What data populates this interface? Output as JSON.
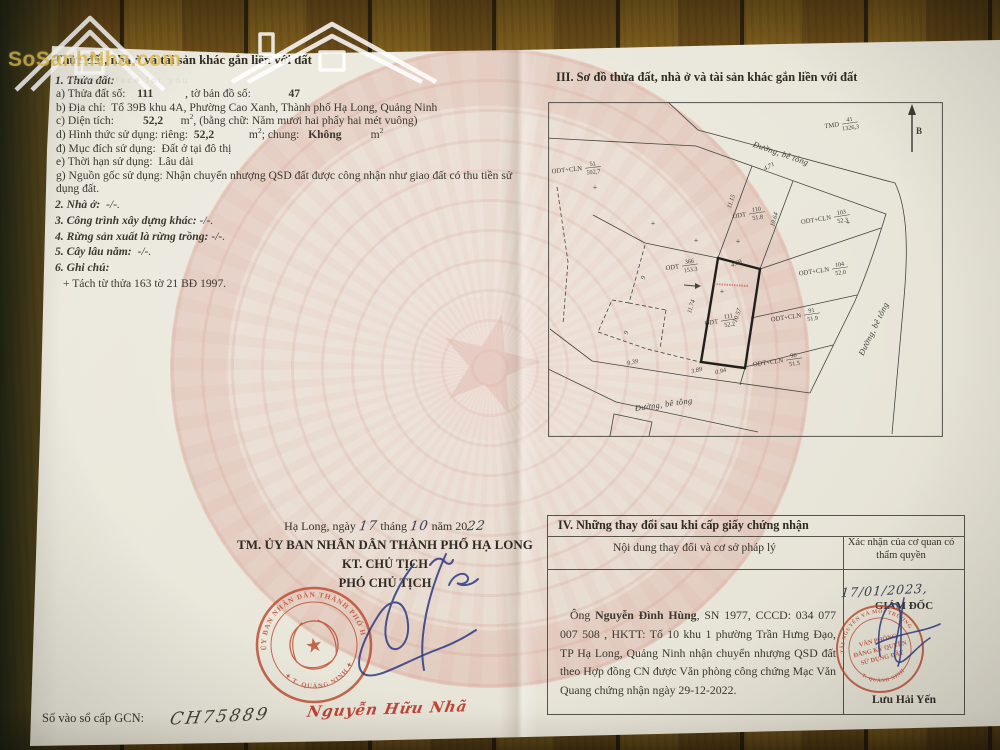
{
  "site_watermark": {
    "brand": "SoSanhNha.com",
    "tagline": "Great place for you"
  },
  "section2": {
    "heading": "II. Thửa đất, nhà ở và tài sản khác gắn liền với đất",
    "lines": [
      {
        "cls": "num",
        "segs": [
          {
            "t": "1. Thửa đất:",
            "bi": 1
          }
        ]
      },
      {
        "cls": "sub",
        "segs": [
          {
            "t": "a) Thửa đất số:    "
          },
          {
            "t": "111",
            "b": 1
          },
          {
            "t": "           , tờ bản đồ số:             "
          },
          {
            "t": "47",
            "b": 1
          }
        ]
      },
      {
        "cls": "sub",
        "segs": [
          {
            "t": "b) Địa chỉ:  Tổ 39B khu 4A, Phường Cao Xanh, Thành phố Hạ Long, Quảng Ninh"
          }
        ]
      },
      {
        "cls": "sub",
        "segs": [
          {
            "t": "c) Diện tích:          "
          },
          {
            "t": "52,2",
            "b": 1
          },
          {
            "t": "      m"
          },
          {
            "t": "2",
            "sup": 1
          },
          {
            "t": ", (bằng chữ: Năm mươi hai phẩy hai mét vuông)"
          }
        ]
      },
      {
        "cls": "sub",
        "segs": [
          {
            "t": "d) Hình thức sử dụng: riêng:  "
          },
          {
            "t": "52,2",
            "b": 1
          },
          {
            "t": "            m"
          },
          {
            "t": "2",
            "sup": 1
          },
          {
            "t": "; chung:   "
          },
          {
            "t": "Không",
            "b": 1
          },
          {
            "t": "          m"
          },
          {
            "t": "2",
            "sup": 1
          }
        ]
      },
      {
        "cls": "sub",
        "segs": [
          {
            "t": "đ) Mục đích sử dụng:  Đất ở tại đô thị"
          }
        ]
      },
      {
        "cls": "sub",
        "segs": [
          {
            "t": "e) Thời hạn sử dụng:  Lâu dài"
          }
        ]
      },
      {
        "cls": "sub",
        "segs": [
          {
            "t": "g) Nguồn gốc sử dụng: Nhận chuyển nhượng QSD đất được công nhận như giao đất có thu tiền sử dụng đất."
          }
        ]
      },
      {
        "cls": "num g",
        "segs": [
          {
            "t": "2. Nhà ở:",
            "bi": 1
          },
          {
            "t": "  -/-.",
            "i": 1
          }
        ]
      },
      {
        "cls": "num g",
        "segs": [
          {
            "t": "3. Công trình xây dựng khác:",
            "bi": 1
          },
          {
            "t": " -/-.",
            "i": 1
          }
        ]
      },
      {
        "cls": "num g",
        "segs": [
          {
            "t": "4. Rừng sản xuất là rừng trồng:",
            "bi": 1
          },
          {
            "t": " -/-.",
            "i": 1
          }
        ]
      },
      {
        "cls": "num g",
        "segs": [
          {
            "t": "5. Cây lâu năm:",
            "bi": 1
          },
          {
            "t": "  -/-.",
            "i": 1
          }
        ]
      },
      {
        "cls": "num g",
        "segs": [
          {
            "t": "6. Ghi chú:",
            "bi": 1
          }
        ]
      },
      {
        "cls": "note g",
        "segs": [
          {
            "t": "+ Tách từ thửa 163 tờ 21 BĐ 1997."
          }
        ]
      }
    ]
  },
  "issue_block": {
    "dateline": [
      {
        "t": "Hạ Long, ngày "
      },
      {
        "t": "17",
        "hand": 1
      },
      {
        "t": " tháng "
      },
      {
        "t": "10",
        "hand": 1
      },
      {
        "t": " năm 20"
      },
      {
        "t": "22",
        "hand": 1
      }
    ],
    "authority": "TM. ỦY BAN NHÂN DÂN THÀNH PHỐ HẠ LONG",
    "title1": "KT. CHỦ TỊCH",
    "title2": "PHÓ CHỦ TỊCH",
    "signer": "Nguyễn Hữu Nhã",
    "stamp": {
      "ring_top": "ỦY BAN NHÂN DÂN THÀNH PHỐ HẠ LONG",
      "ring_bottom": "✦ T. QUẢNG NINH ✦"
    }
  },
  "gcn": {
    "label": "Số vào sổ cấp GCN:",
    "value": "CH75889"
  },
  "section3": {
    "heading": "III. Sơ đồ thửa đất, nhà ở và tài sản khác gắn liền với đất",
    "north": {
      "label": "B"
    },
    "parcels": [
      {
        "code": "TMD",
        "num": "41",
        "area": "1326,3",
        "x": 293,
        "y": 22,
        "rot": -8
      },
      {
        "code": "ODT+CLN",
        "num": "51",
        "area": "592,7",
        "x": 36,
        "y": 66,
        "rot": -6
      },
      {
        "code": "ODT",
        "num": "110",
        "area": "51.8",
        "x": 200,
        "y": 112,
        "rot": -9
      },
      {
        "code": "ODT+CLN",
        "num": "103",
        "area": "52.3",
        "x": 285,
        "y": 115,
        "rot": -9
      },
      {
        "code": "ODT",
        "num": "366",
        "area": "153.3",
        "x": 133,
        "y": 164,
        "rot": -8
      },
      {
        "code": "ODT+CLN",
        "num": "104",
        "area": "52.0",
        "x": 283,
        "y": 167,
        "rot": -8
      },
      {
        "code": "ODT",
        "num": "111",
        "area": "52.2",
        "x": 172,
        "y": 219,
        "rot": -9,
        "bold": true
      },
      {
        "code": "ODT+CLN",
        "num": "91",
        "area": "51.9",
        "x": 255,
        "y": 213,
        "rot": -8
      },
      {
        "code": "ODT+CLN",
        "num": "90",
        "area": "51.5",
        "x": 237,
        "y": 258,
        "rot": -8
      }
    ],
    "dimensions": [
      {
        "t": "4.71",
        "x": 222,
        "y": 66,
        "rot": -30
      },
      {
        "t": "11.15",
        "x": 185,
        "y": 100,
        "rot": -72
      },
      {
        "t": "10.64",
        "x": 228,
        "y": 118,
        "rot": -74
      },
      {
        "t": "4.69",
        "x": 189,
        "y": 163,
        "rot": -22
      },
      {
        "t": "11.74",
        "x": 145,
        "y": 205,
        "rot": -73
      },
      {
        "t": "10.57",
        "x": 191,
        "y": 214,
        "rot": -71
      },
      {
        "t": "9.39",
        "x": 85,
        "y": 262,
        "rot": -13
      },
      {
        "t": "3.89",
        "x": 149,
        "y": 270,
        "rot": -14
      },
      {
        "t": "0.94",
        "x": 173,
        "y": 271,
        "rot": -14
      }
    ],
    "road_labels": [
      {
        "t": "Đường, bê tông",
        "x": 232,
        "y": 54,
        "rot": 19
      },
      {
        "t": "Đường, bê tông",
        "x": 328,
        "y": 228,
        "rot": -64
      },
      {
        "t": "Đường, bê tông",
        "x": 116,
        "y": 305,
        "rot": -8
      }
    ],
    "small_markers": [
      {
        "t": "9",
        "x": 97,
        "y": 176,
        "rot": -75
      },
      {
        "t": "9",
        "x": 80,
        "y": 231,
        "rot": -75
      }
    ],
    "plus_marks": [
      [
        47,
        88
      ],
      [
        105,
        124
      ],
      [
        148,
        141
      ],
      [
        190,
        142
      ],
      [
        300,
        123
      ],
      [
        174,
        192
      ]
    ]
  },
  "section4": {
    "heading": "IV. Những thay đổi sau khi cấp giấy chứng nhận",
    "col1": "Nội dung thay đổi và cơ sở pháp lý",
    "col2": "Xác nhận của cơ quan có thẩm quyền",
    "entry": [
      {
        "t": "Ông "
      },
      {
        "t": "Nguyễn Đình Hùng",
        "b": 1
      },
      {
        "t": ", SN 1977, CCCD: 034 077 007 508 , HKTT: Tổ 10 khu 1 phường Trần Hưng Đạo, TP Hạ Long, Quảng Ninh nhận chuyển nhượng QSD đất theo Hợp đồng CN được Văn phòng công chứng Mạc Văn Quang chứng nhận ngày 29-12-2022."
      }
    ],
    "confirm": {
      "date": "17/01/2023,",
      "title": "GIÁM ĐỐC",
      "name": "Lưu Hải Yến",
      "stamp": {
        "ring_top": "TÀI NGUYÊN VÀ MÔI TRƯỜNG",
        "ring_bottom": "T. QUẢNG NINH",
        "center": [
          "VĂN PHÒNG",
          "ĐĂNG KÝ QUYỀN",
          "SỬ DỤNG ĐẤT"
        ]
      }
    }
  }
}
